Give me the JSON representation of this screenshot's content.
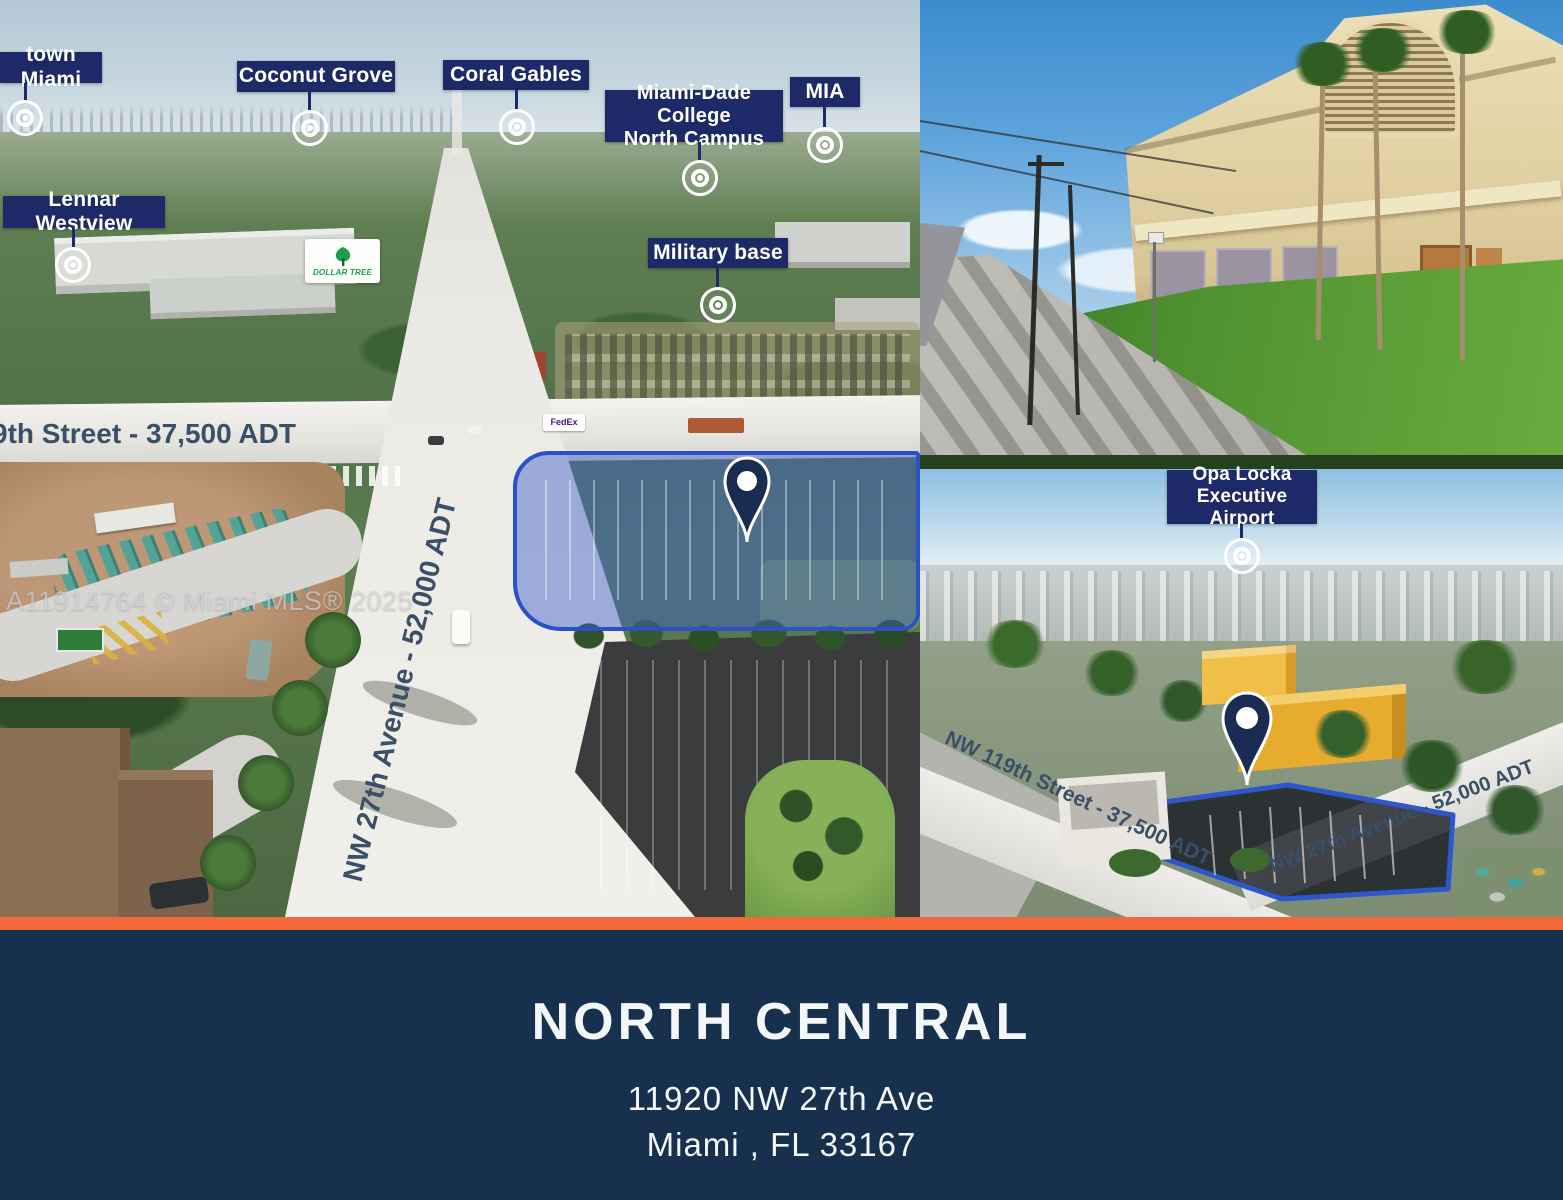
{
  "watermark": "A11914764 © Miami MLS® 2025",
  "colors": {
    "accent_orange": "#F2683B",
    "banner_navy": "#17304E",
    "callout_navy": "#1E2A67",
    "highlight_blue": "#2B50C8",
    "dollar_tree_green": "#1E9E49",
    "street_text_slate": "#3A4F68"
  },
  "left_photo": {
    "callouts": [
      {
        "lines": [
          "town Miami",
          ""
        ]
      },
      {
        "lines": [
          "Coconut Grove",
          ""
        ]
      },
      {
        "lines": [
          "Coral Gables",
          ""
        ]
      },
      {
        "lines": [
          "Miami-Dade College",
          "North Campus"
        ]
      },
      {
        "lines": [
          "MIA",
          ""
        ]
      },
      {
        "lines": [
          "Lennar Westview",
          ""
        ]
      },
      {
        "lines": [
          "Military base",
          ""
        ]
      }
    ],
    "street_label_horizontal": "9th Street - 37,500 ADT",
    "street_label_vertical": "NW 27th Avenue - 52,000 ADT",
    "dollar_tree_sign": "DOLLAR TREE",
    "fedex_truck": "FedEx"
  },
  "bottom_right_photo": {
    "callout": {
      "lines": [
        "Opa Locka",
        "Executive Airport"
      ]
    },
    "street_label_1": "NW 119th Street - 37,500 ADT",
    "street_label_2": "NW 27th Avenue - 52,000 ADT"
  },
  "banner": {
    "title": "NORTH CENTRAL",
    "address_line1": "11920 NW 27th Ave",
    "address_line2": "Miami , FL 33167"
  }
}
